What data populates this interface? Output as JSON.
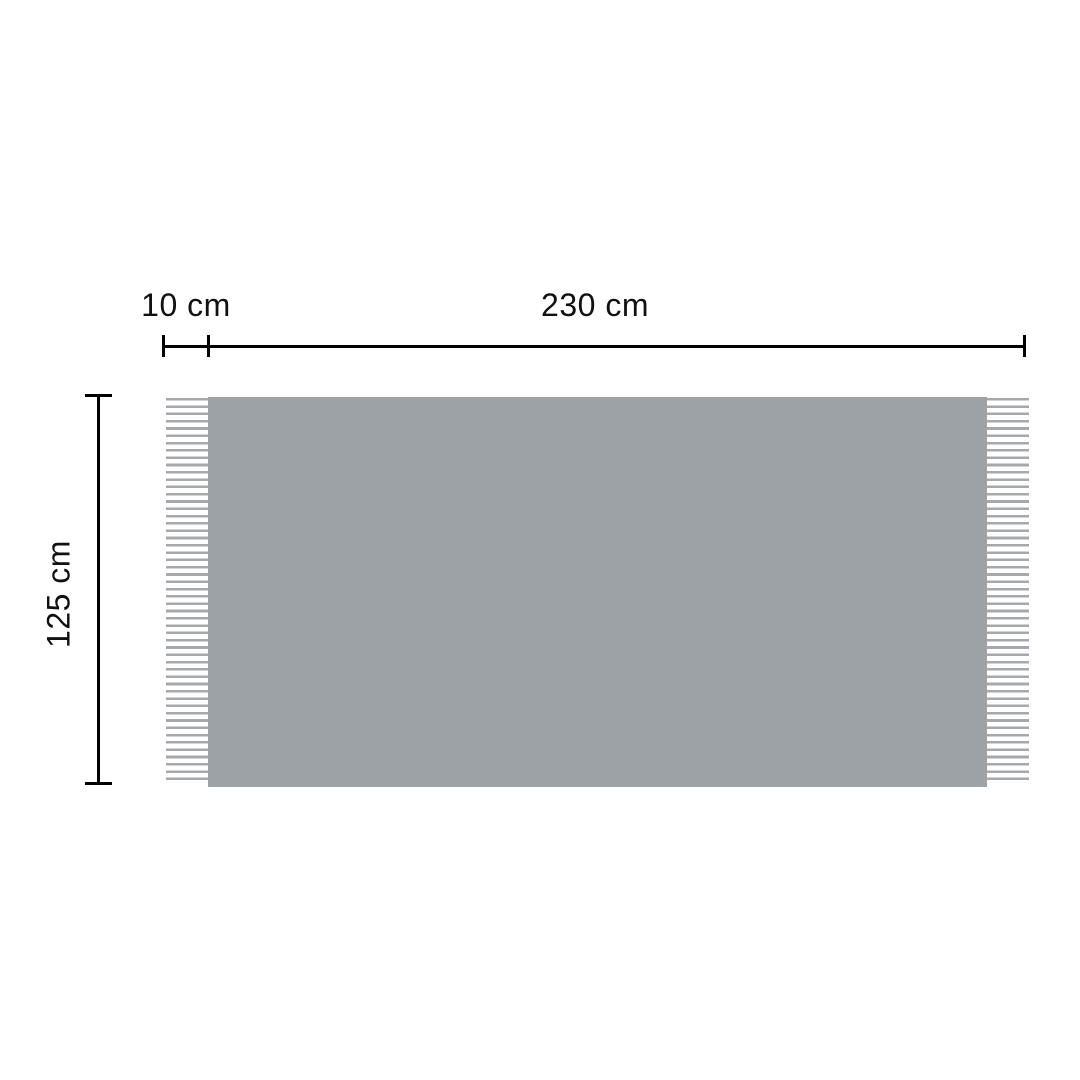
{
  "diagram": {
    "labels": {
      "fringe_length": "10 cm",
      "width": "230 cm",
      "height": "125 cm"
    },
    "measurements": {
      "fringe_length_cm": 10,
      "width_cm": 230,
      "height_cm": 125,
      "unit": "cm"
    },
    "colors": {
      "background": "#FFFFFF",
      "fabric": "#9DA2A6",
      "fringe": "#A5A9AD",
      "dimension_line": "#000000",
      "label_text": "#111111"
    }
  }
}
